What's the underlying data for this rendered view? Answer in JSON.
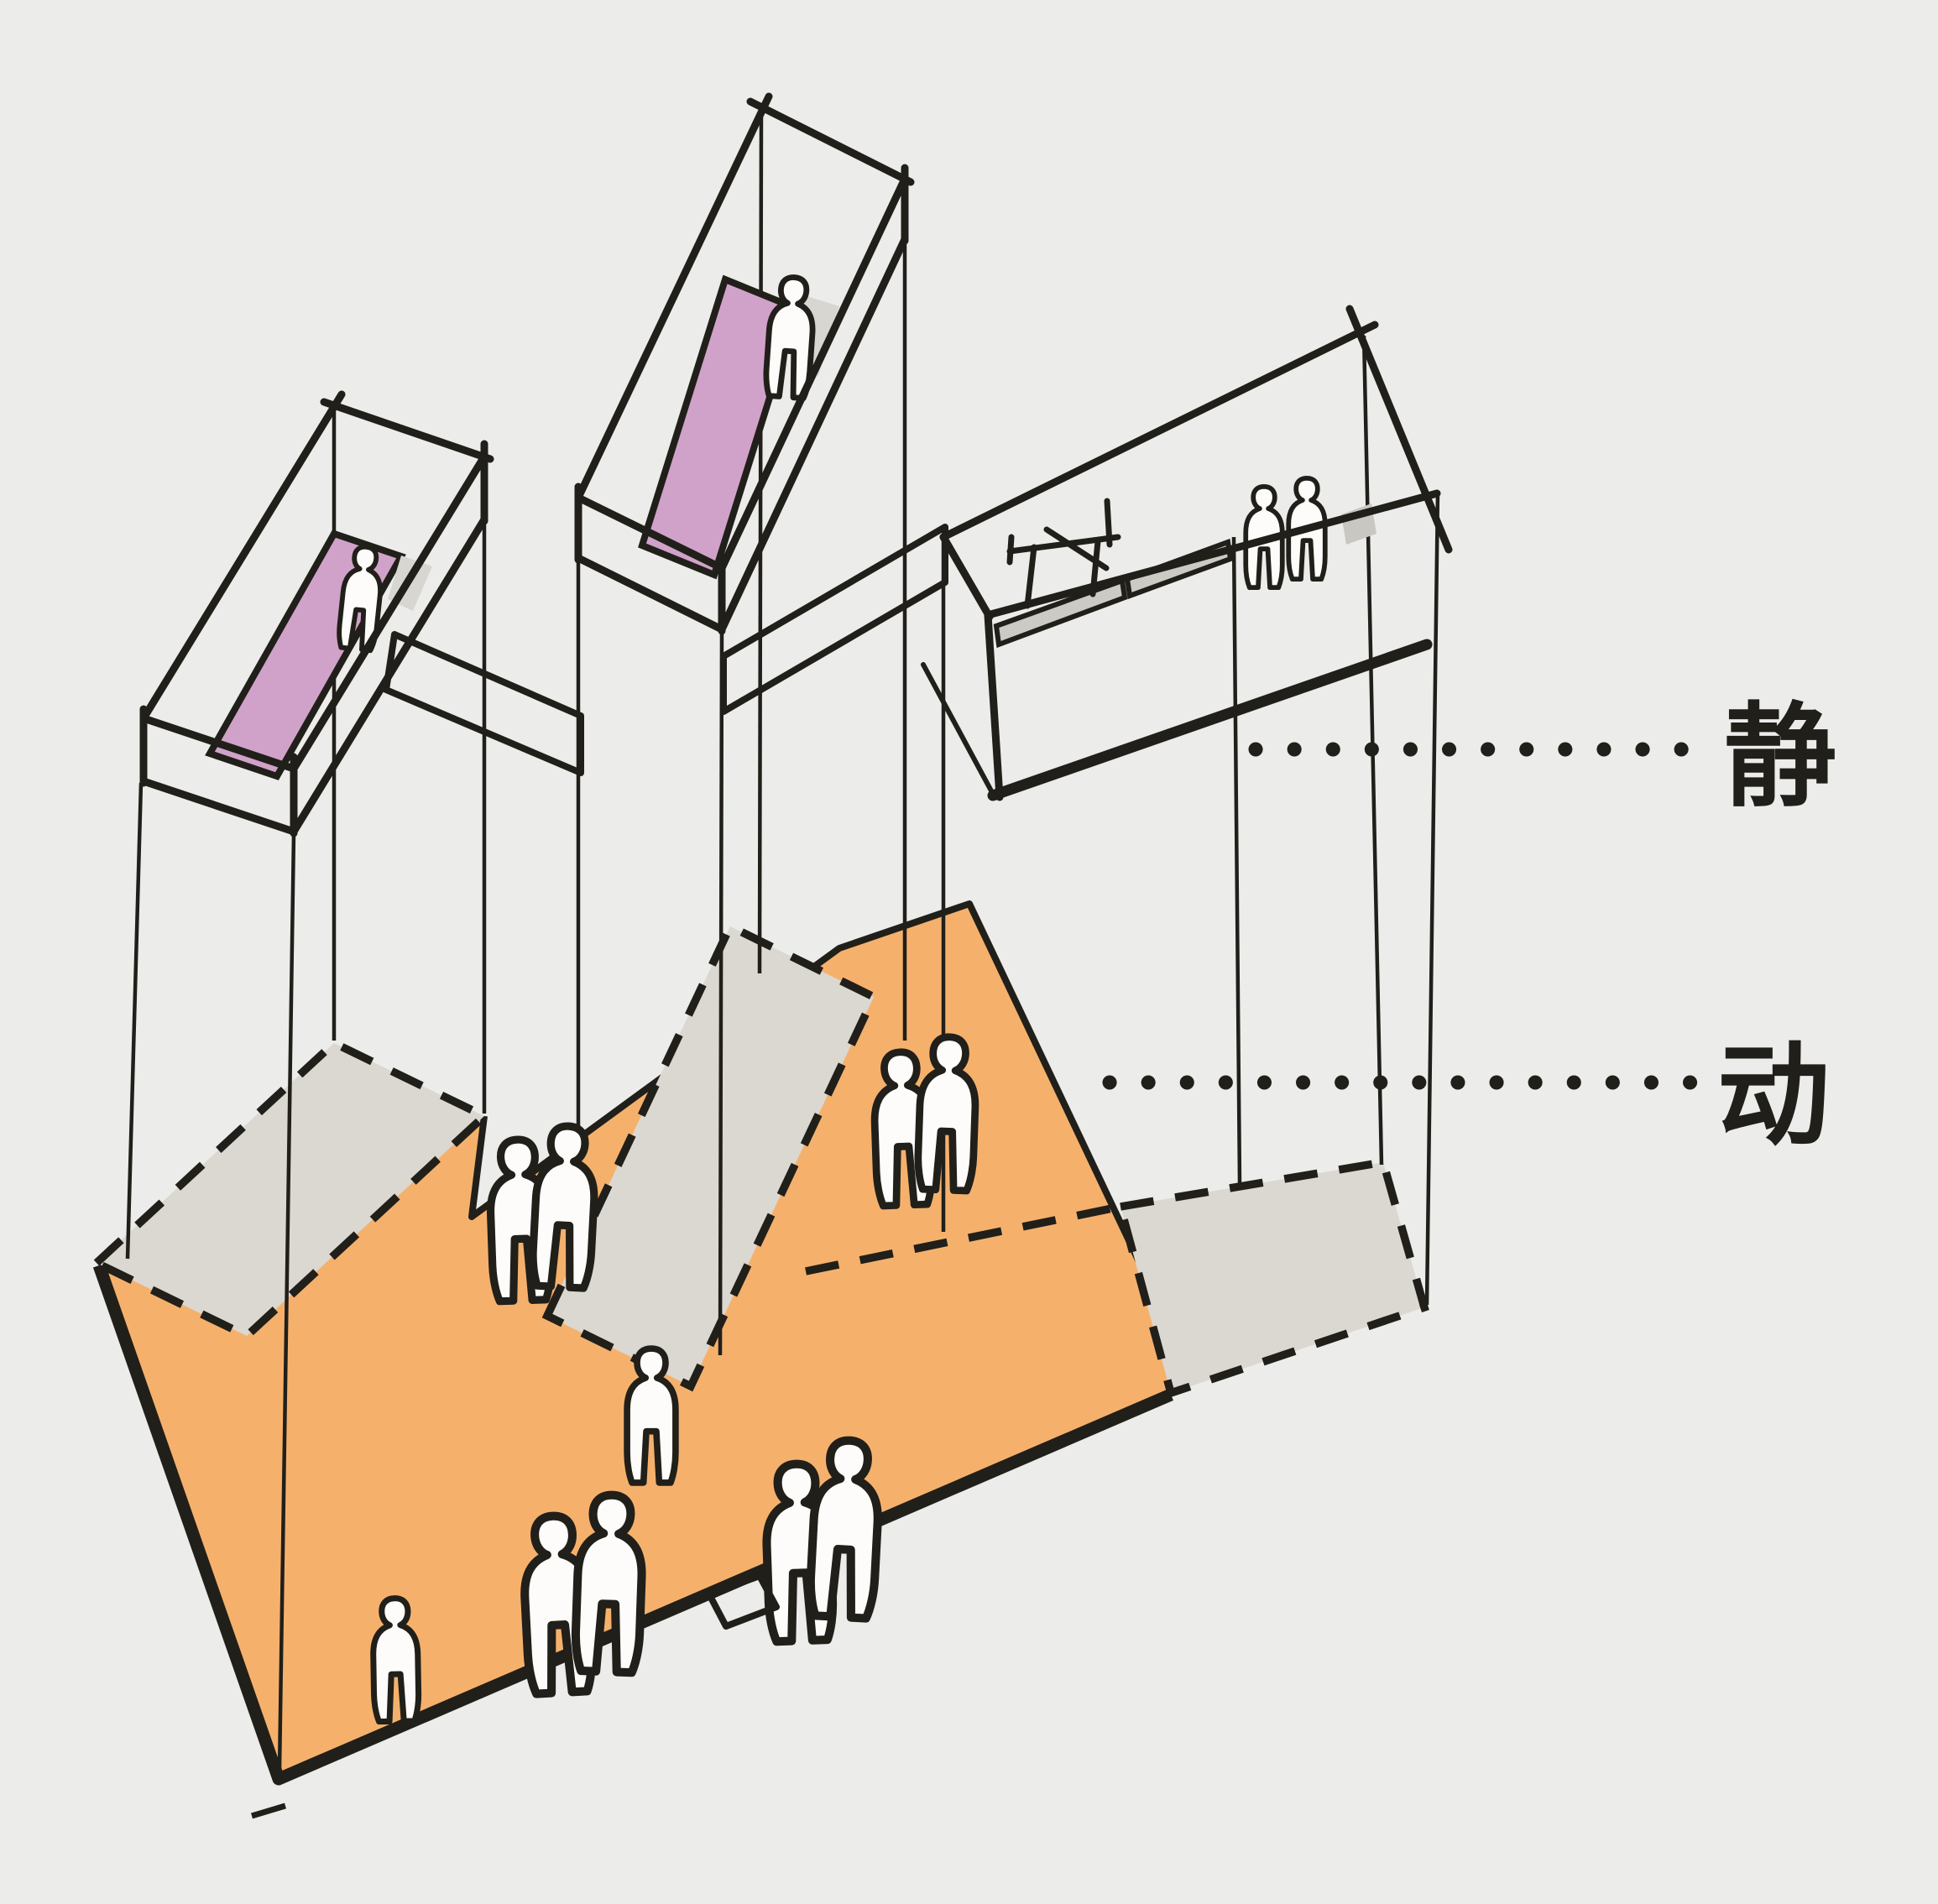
{
  "labels": {
    "quiet": "静",
    "active": "动"
  },
  "palette": {
    "background": "#ececea",
    "ink": "#211f1a",
    "ground_orange": "#f5b16c",
    "footprint_gray": "#dbd8d2",
    "box_floor_purple": "#d0a2c9",
    "balcony_floor_gray": "#cccac4",
    "figure_fill": "#fdfcfa"
  },
  "scene": {
    "type": "hand-drawn axonometric architecture concept sketch",
    "upper_level": {
      "elevated_boxes": 3,
      "box_floor_colors": [
        "purple",
        "purple",
        "gray"
      ],
      "people_in_left_box": 1,
      "people_in_middle_box": 1,
      "people_in_right_box": 2,
      "leader_label": "静"
    },
    "ground_level": {
      "surface": "orange sloped deck with dashed gray footprint slabs",
      "people_on_ground": 10,
      "leader_label": "动"
    },
    "leader_style": "dotted"
  }
}
